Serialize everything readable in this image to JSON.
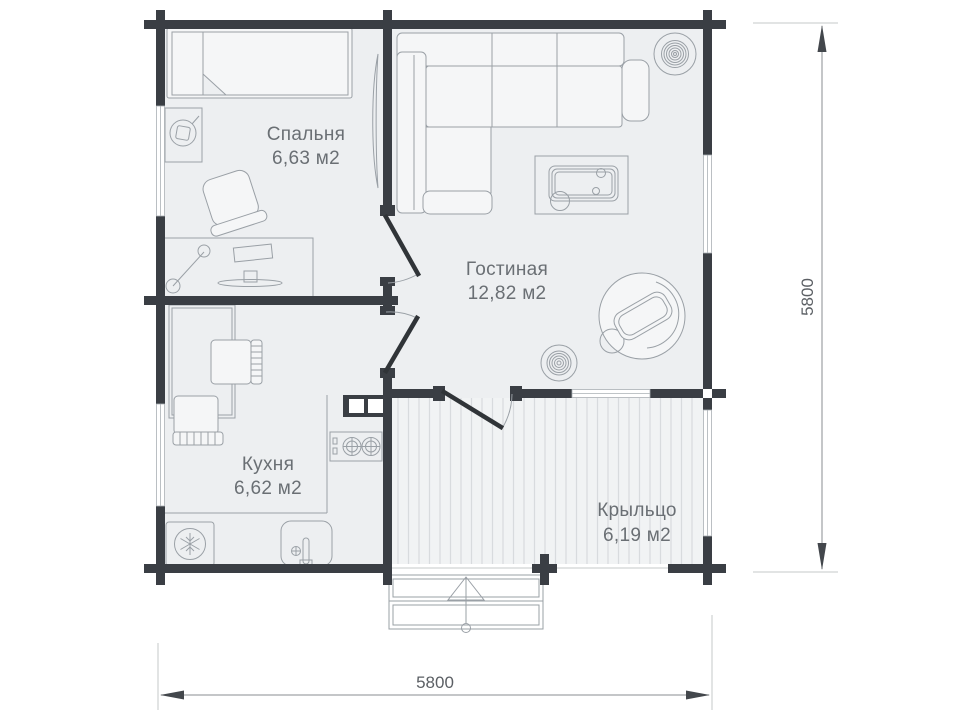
{
  "plan_title": "house-floor-plan",
  "rooms": [
    {
      "id": "bedroom",
      "name": "Спальня",
      "area": "6,63 м2"
    },
    {
      "id": "living",
      "name": "Гостиная",
      "area": "12,82 м2"
    },
    {
      "id": "kitchen",
      "name": "Кухня",
      "area": "6,62 м2"
    },
    {
      "id": "porch",
      "name": "Крыльцо",
      "area": "6,19 м2"
    }
  ],
  "dimensions": {
    "right_vertical": "5800",
    "bottom_horizontal": "5800"
  },
  "colors": {
    "wall": "#3a3e44",
    "floor": "#edeff1",
    "porch_floor": "#f1f3f4",
    "porch_stripe": "#d8dbde",
    "furniture_fill": "#f5f6f7",
    "furniture_line": "#9aa0a6",
    "window": "#ffffff",
    "label_text": "#6a6f74",
    "dimension_text": "#5b5f64",
    "background": "#ffffff"
  },
  "furniture": [
    "bed",
    "nightstand-lamp",
    "armchair",
    "desk",
    "floor-lamp",
    "desk-fan",
    "corner-sofa",
    "coffee-table",
    "speaker-large",
    "speaker-small",
    "papasan-chair",
    "dining-table",
    "dining-chair-1",
    "dining-chair-2",
    "kitchen-cabinet",
    "stove-two-burners",
    "sink",
    "fridge",
    "entrance-steps"
  ]
}
